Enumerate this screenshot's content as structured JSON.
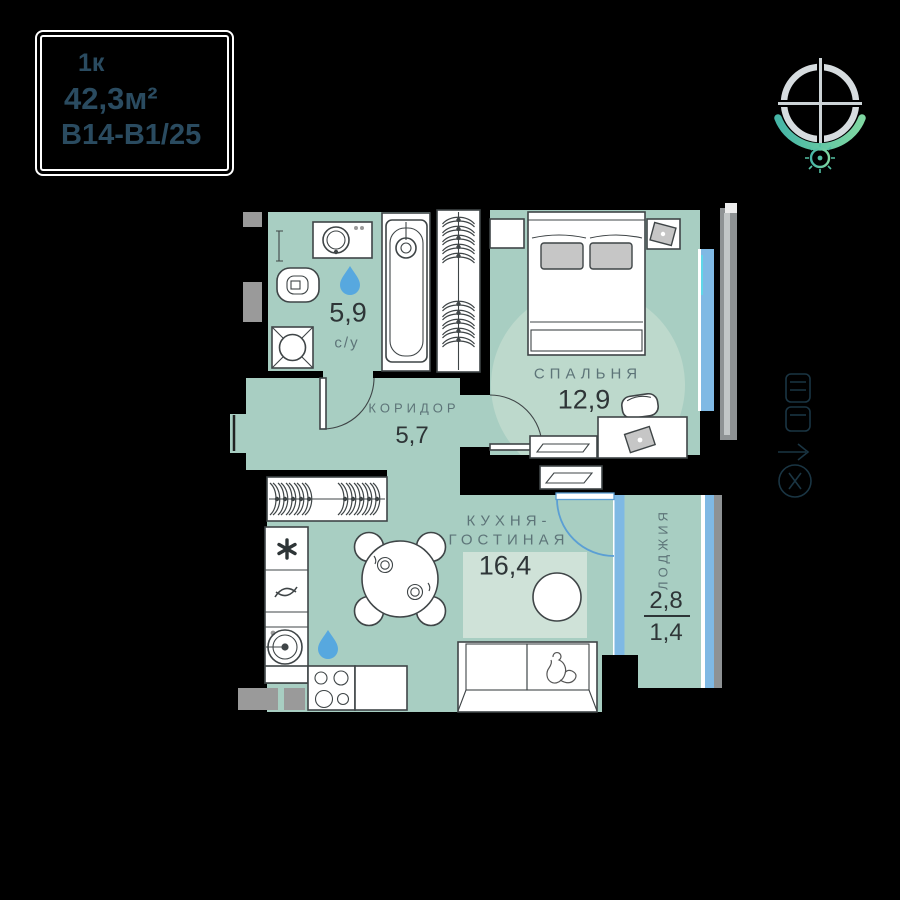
{
  "info_card": {
    "rooms_count": "1к",
    "total_area": "42,3м²",
    "unit_code": "В14-В1/25"
  },
  "plan": {
    "rooms": {
      "bathroom": {
        "label": "с/у",
        "area": "5,9"
      },
      "corridor": {
        "label": "КОРИДОР",
        "area": "5,7"
      },
      "bedroom": {
        "label": "СПАЛЬНЯ",
        "area": "12,9"
      },
      "kitchen_living": {
        "label_line1": "КУХНЯ-",
        "label_line2": "ГОСТИНАЯ",
        "area": "16,4"
      },
      "loggia": {
        "label": "ЛОДЖИЯ",
        "area_full": "2,8",
        "area_reduced": "1,4"
      }
    }
  },
  "colors": {
    "wall": "#000000",
    "mint": "#a8cec2",
    "accent": "#bdd9cc",
    "rug": "#cfe2d8",
    "blue": "#7fb9e4",
    "drop": "#57a8df",
    "vent": "#9a9a9a",
    "stroke": "#3f4547",
    "muted": "#5d7478",
    "dark": "#2e3537",
    "cardtext": "#2a4b60",
    "logo_gray": "#d6dcdf",
    "logo_teal": "#52bfa3"
  }
}
